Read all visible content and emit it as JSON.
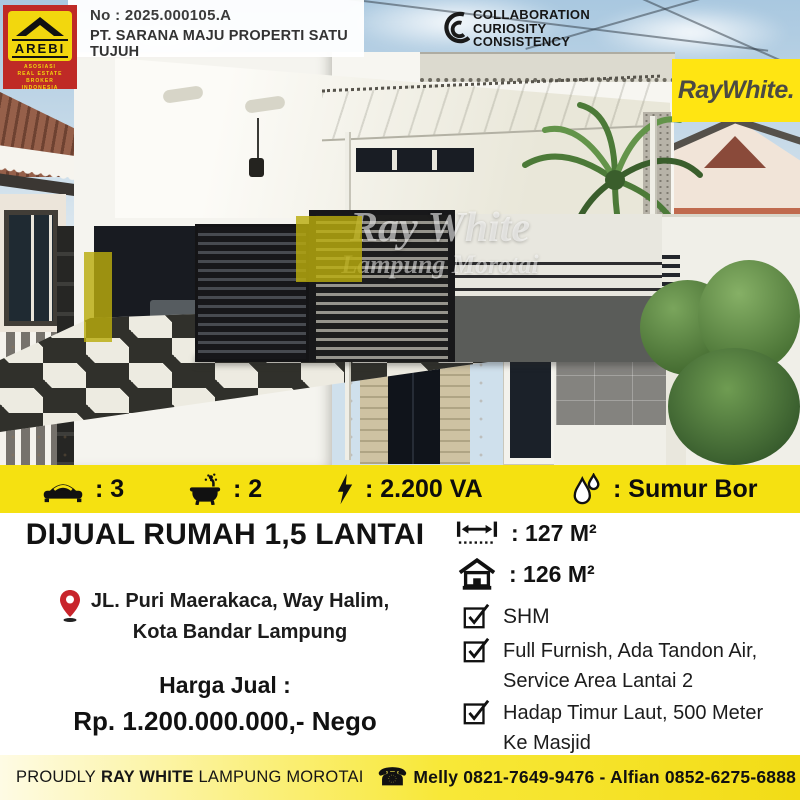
{
  "colors": {
    "brand_yellow": "#F5E111",
    "arebi_red": "#BF2A26",
    "pin_red": "#C8242B",
    "text_black": "#121212"
  },
  "header": {
    "arebi": {
      "name": "AREBI",
      "line1": "ASOSIASI",
      "line2": "REAL ESTATE BROKER",
      "line3": "INDONESIA"
    },
    "license_no": "No : 2025.000105.A",
    "company": "PT. SARANA MAJU PROPERTI SATU TUJUH",
    "values_line1": "COLLABORATION",
    "values_line2": "CURIOSITY",
    "values_line3": "CONSISTENCY",
    "brand": "RayWhite."
  },
  "watermark": {
    "line1": "Ray White",
    "line2": "Lampung Morotai"
  },
  "features": [
    {
      "icon": "bed-icon",
      "value": ": 3"
    },
    {
      "icon": "bath-icon",
      "value": ": 2"
    },
    {
      "icon": "lightning-icon",
      "value": ": 2.200 VA"
    },
    {
      "icon": "water-drop-icon",
      "value": ": Sumur Bor"
    }
  ],
  "listing": {
    "title": "DIJUAL RUMAH 1,5 LANTAI",
    "address_line1": "JL. Puri Maerakaca, Way Halim,",
    "address_line2": "Kota Bandar Lampung",
    "price_label": "Harga Jual :",
    "price": "Rp. 1.200.000.000,- Nego",
    "land_area": ": 127 M²",
    "building_area": ": 126 M²",
    "checklist": [
      "SHM",
      "Full Furnish, Ada Tandon Air, Service Area Lantai 2",
      "Hadap Timur Laut, 500 Meter Ke Masjid"
    ]
  },
  "footer": {
    "proudly": "PROUDLY",
    "brand": "RAY WHITE",
    "office": "LAMPUNG MOROTAI",
    "phone_icon": "☎",
    "contact": "Melly 0821-7649-9476 - Alfian 0852-6275-6888"
  }
}
